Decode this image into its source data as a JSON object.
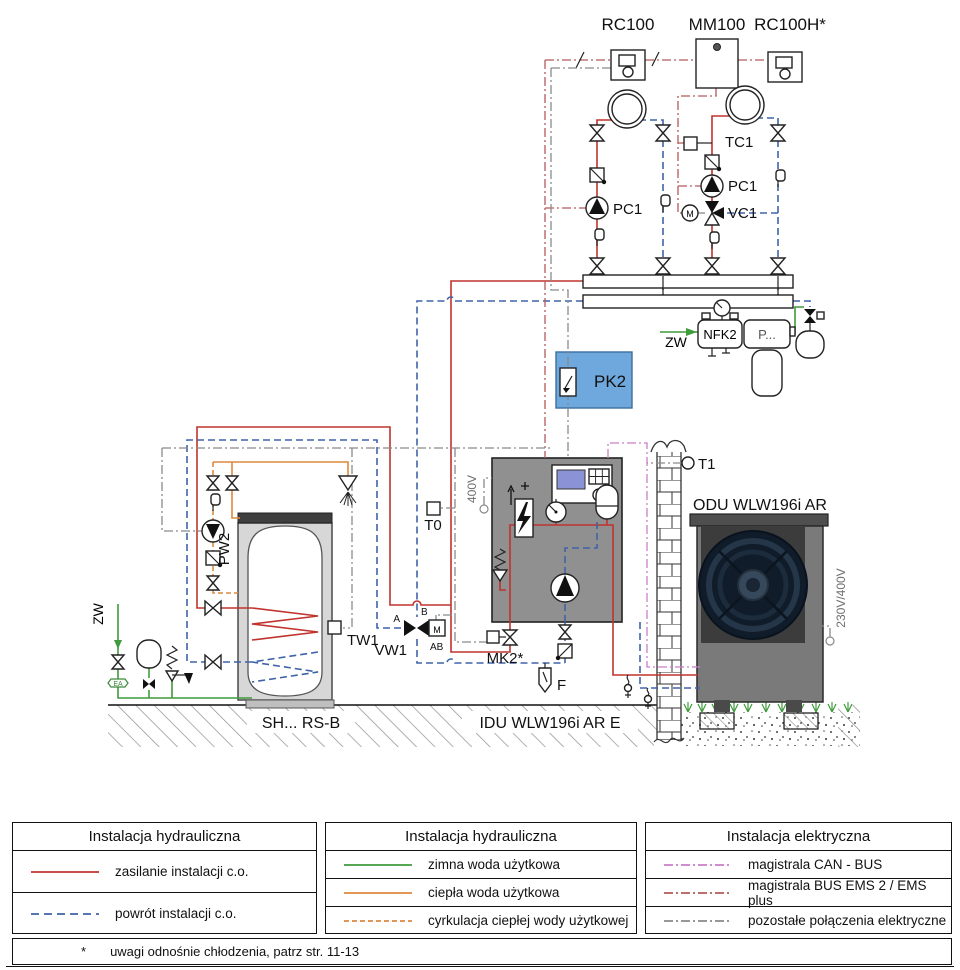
{
  "colors": {
    "supply_red": "#c0332f",
    "return_blue": "#3f63a8",
    "cold_green": "#3f9b3c",
    "dhw_orange": "#dd8a3e",
    "can_pink": "#c97fc9",
    "ems_red": "#b35a5a",
    "elec_gray": "#8a8a8a",
    "pk2_blue": "#6fa8dc"
  },
  "components": {
    "rc100": "RC100",
    "mm100": "MM100",
    "rc100h": "RC100H*",
    "tc1": "TC1",
    "pc1_a": "PC1",
    "pc1_b": "PC1",
    "vc1": "VC1",
    "m_vc1": "M",
    "m_vw1": "M",
    "pk2": "PK2",
    "nfk2": "NFK2",
    "p_dots": "P...",
    "zw_main": "ZW",
    "zw_tank": "ZW",
    "ea": "EA",
    "pw2": "PW2",
    "tw1": "TW1",
    "t0": "T0",
    "t1": "T1",
    "vw1": "VW1",
    "port_a": "A",
    "port_b": "B",
    "port_ab": "AB",
    "mk2": "MK2*",
    "f_filter": "F",
    "v400": "400V",
    "v230": "230V/400V",
    "tank_name": "SH... RS-B",
    "idu_name": "IDU WLW196i AR E",
    "odu_name": "ODU WLW196i AR"
  },
  "legend": {
    "boxes": [
      {
        "title": "Instalacja hydrauliczna",
        "items": [
          {
            "label": "zasilanie instalacji c.o.",
            "color": "#c0332f"
          },
          {
            "label": "powrót instalacji c.o.",
            "color": "#3f63a8"
          }
        ]
      },
      {
        "title": "Instalacja hydrauliczna",
        "items": [
          {
            "label": "zimna woda użytkowa",
            "color": "#3f9b3c"
          },
          {
            "label": "ciepła woda użytkowa",
            "color": "#dd8a3e"
          },
          {
            "label": "cyrkulacja ciepłej wody użytkowej",
            "color": "#dd8a3e"
          }
        ]
      },
      {
        "title": "Instalacja elektryczna",
        "items": [
          {
            "label": "magistrala CAN - BUS",
            "color": "#c97fc9"
          },
          {
            "label": "magistrala BUS EMS 2 / EMS plus",
            "color": "#b35a5a"
          },
          {
            "label": "pozostałe połączenia elektryczne",
            "color": "#8a8a8a"
          }
        ]
      }
    ]
  },
  "footnote": {
    "marker": "*",
    "text": "uwagi odnośnie chłodzenia, patrz str. 11-13"
  }
}
